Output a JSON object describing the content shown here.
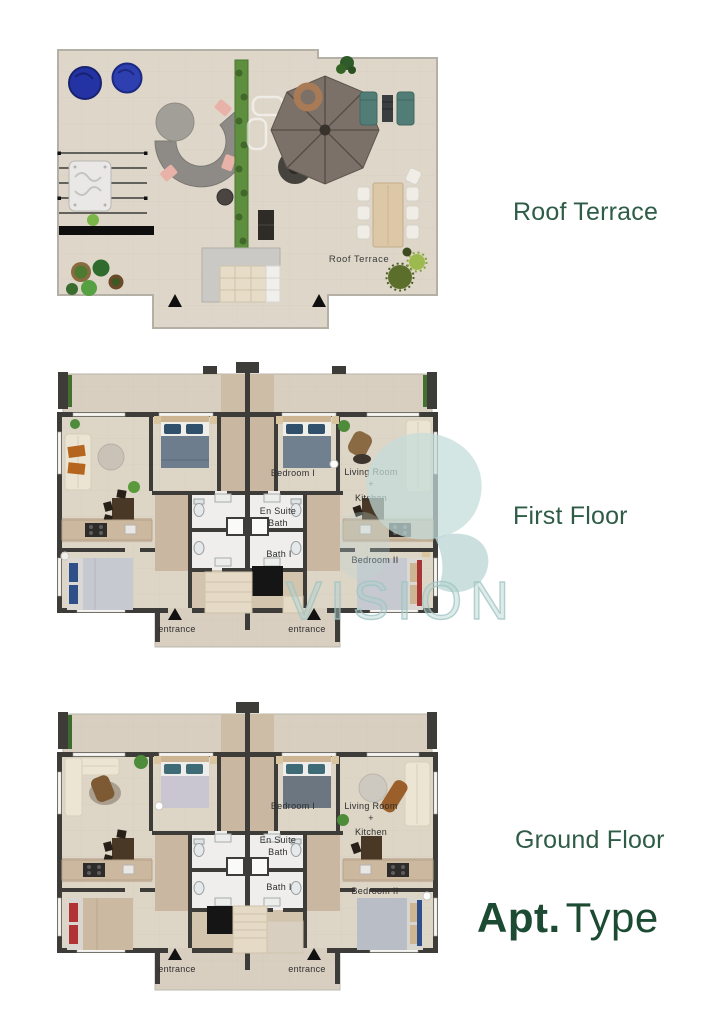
{
  "side_labels": {
    "roof": "Roof Terrace",
    "first": "First Floor",
    "ground": "Ground Floor"
  },
  "branding": {
    "apt_bold": "Apt.",
    "apt_light": "Type"
  },
  "watermark": {
    "text": "VISION"
  },
  "roof_plan": {
    "label": "Roof Terrace"
  },
  "room_labels": {
    "bedroom1": "Bedroom I",
    "living_room": "Living Room",
    "plus": "+",
    "kitchen": "Kitchen",
    "ensuite_line1": "En Suite",
    "ensuite_line2": "Bath",
    "bath1": "Bath I",
    "bedroom2": "Bedroom II",
    "entrance": "entrance"
  },
  "colors": {
    "label_green": "#2f5c47",
    "apt_green": "#1c4a33",
    "watermark_teal": "#bed9d7",
    "wall": "#3e3c39",
    "floor_beige": "#ddd5c6",
    "floor_tan": "#c9b7a2",
    "bath_white": "#efeeec"
  }
}
